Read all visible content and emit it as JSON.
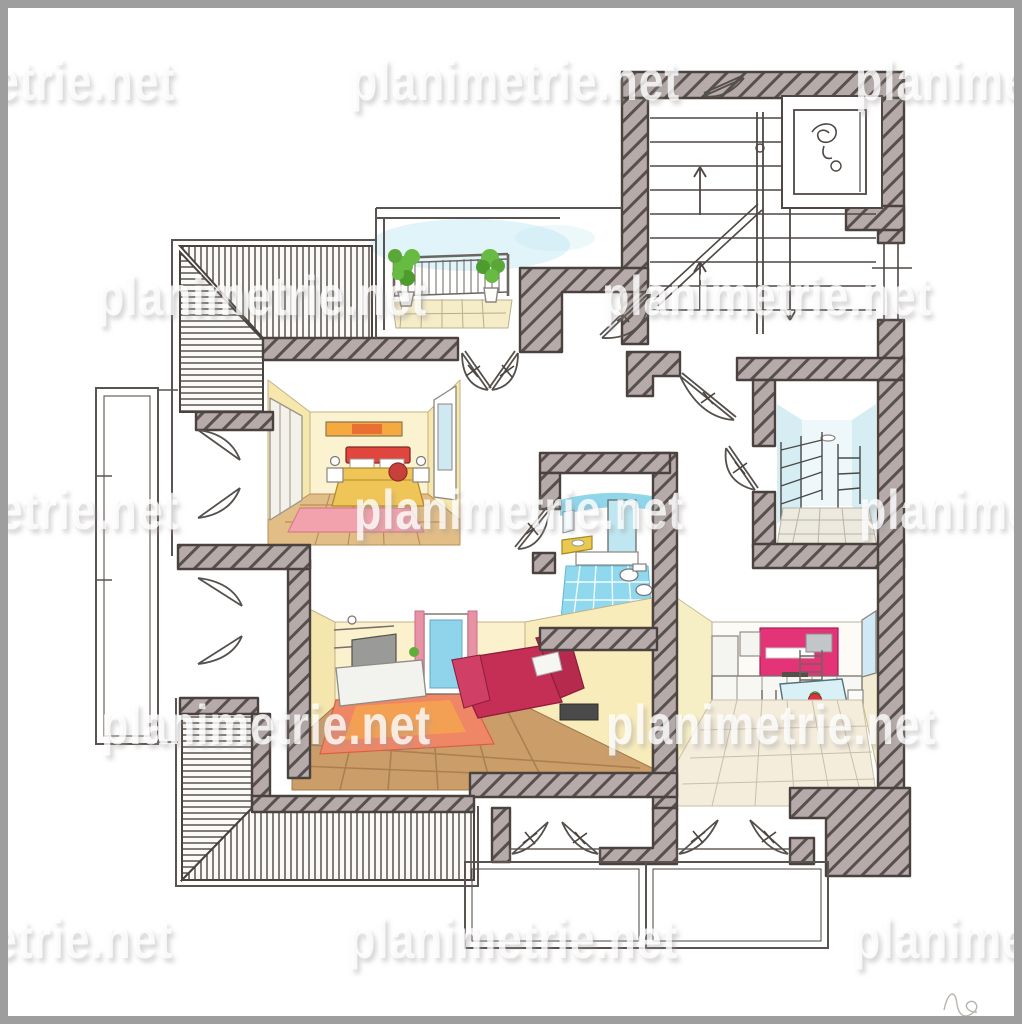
{
  "image": {
    "kind": "hand-drawn watercolor floor plan (perspective cut-away rooms)",
    "frame_color": "#9e9e9e",
    "paper_color": "#ffffff"
  },
  "watermark": {
    "text": "planimetrie.net",
    "font_size": 56,
    "tile_width": 330,
    "text_color": "#ffffff",
    "shadow_color": "#9e9a98",
    "rows": [
      {
        "baseline": 100,
        "starts": [
          -155,
          350,
          855
        ]
      },
      {
        "baseline": 315,
        "starts": [
          -408,
          97,
          602,
          1107
        ]
      },
      {
        "baseline": 529,
        "starts": [
          -151,
          354,
          859
        ]
      },
      {
        "baseline": 744,
        "starts": [
          -404,
          101,
          606,
          1111
        ]
      },
      {
        "baseline": 958,
        "starts": [
          -157,
          348,
          853
        ]
      }
    ]
  },
  "palette": {
    "wall_fill": "#b6abaa",
    "wall_stroke": "#4a423e",
    "hatch_line": "#57504c",
    "stripe_line": "#3f3a36",
    "pencil": "#5a534f",
    "yellow_wall": "#f8efc4",
    "wood_floor": "#c99c68",
    "bed_red": "#e0453e",
    "bedspread_yellow": "#f0c557",
    "sofa_crimson": "#c52f55",
    "rug_pink": "#f2a2ac",
    "rug_orange": "#ef8666",
    "kitchen_magenta": "#e43377",
    "bath_blue": "#8fd8ee",
    "sky_blue": "#c2e9f3",
    "plant_green": "#67bb42",
    "balcony_floor": "#f5ecc8",
    "signature_gray": "#b9b3ad"
  },
  "rooms": [
    {
      "id": "stairwell",
      "label": "stairwell, two flights, up and down arrows"
    },
    {
      "id": "elevator",
      "label": "elevator shaft with symbol"
    },
    {
      "id": "top-balcony",
      "label": "balcony with railing and two potted plants"
    },
    {
      "id": "attic-slope",
      "label": "striped sloped-roof bands, top-left and bottom-left"
    },
    {
      "id": "bedroom",
      "label": "bedroom: red bed, yellow walls, wardrobe, pink rug"
    },
    {
      "id": "bathroom",
      "label": "bathroom: blue tiled floor, shower, toilet, bidet"
    },
    {
      "id": "storage",
      "label": "storage room with wire shelving"
    },
    {
      "id": "kitchen",
      "label": "kitchen: magenta units, dining table, window"
    },
    {
      "id": "living-room",
      "label": "living room: crimson sofa, TV wall, window, orange rug"
    },
    {
      "id": "side-balcony",
      "label": "long narrow left balcony"
    },
    {
      "id": "rear-balconies",
      "label": "two rear balconies behind french doors"
    }
  ],
  "signature": {
    "glyph": "faint hand-drawn initials squiggle, bottom right"
  }
}
